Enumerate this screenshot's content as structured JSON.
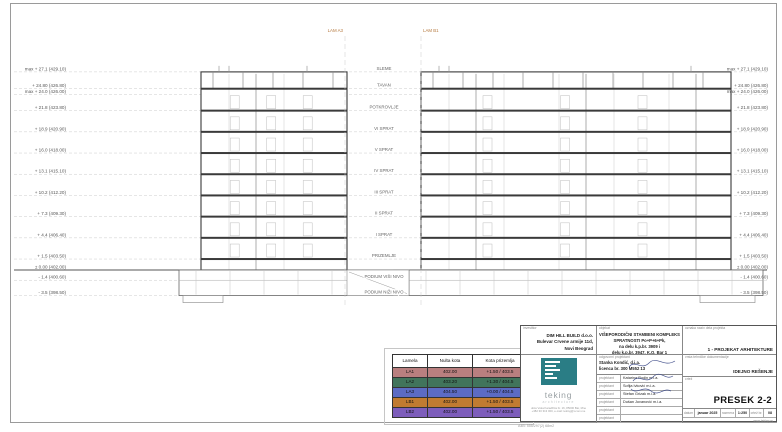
{
  "drawing": {
    "section_lines": [
      {
        "label": "LAM A3"
      },
      {
        "label": "LAM B1"
      }
    ],
    "levels": [
      {
        "elev": 27.1,
        "left": "max + 27.1 (429.10)",
        "right": "max + 27.1 (429.10)"
      },
      {
        "elev": 24.8,
        "left": "+ 24.80 (426.80)",
        "right": "+ 24.80 (426.80)"
      },
      {
        "elev": 24.0,
        "left": "max + 24.0 (426.00)",
        "right": "max + 24.0 (426.00)"
      },
      {
        "elev": 21.8,
        "left": "+ 21.8 (423.80)",
        "right": "+ 21.8 (423.80)"
      },
      {
        "elev": 18.9,
        "left": "+ 18.9 (420.90)",
        "right": "+ 18.9 (420.90)"
      },
      {
        "elev": 16.0,
        "left": "+ 16.0 (418.00)",
        "right": "+ 16.0 (418.00)"
      },
      {
        "elev": 13.1,
        "left": "+ 13.1 (415.10)",
        "right": "+ 13.1 (415.10)"
      },
      {
        "elev": 10.2,
        "left": "+ 10.2 (412.20)",
        "right": "+ 10.2 (412.20)"
      },
      {
        "elev": 7.3,
        "left": "+ 7.3 (409.30)",
        "right": "+ 7.3 (409.30)"
      },
      {
        "elev": 4.4,
        "left": "+ 4.4 (406.40)",
        "right": "+ 4.4 (406.40)"
      },
      {
        "elev": 1.5,
        "left": "+ 1.5 (403.50)",
        "right": "+ 1.5 (403.50)"
      },
      {
        "elev": 0.0,
        "left": "± 0.00 (402.00)",
        "right": "± 0.00 (402.00)"
      },
      {
        "elev": -1.4,
        "left": "- 1.4 (400.60)",
        "right": "- 1.4 (400.60)"
      },
      {
        "elev": -3.5,
        "left": "- 3.5 (398.50)",
        "right": "- 3.5 (398.50)"
      }
    ],
    "floors": [
      {
        "name": "SLEME",
        "elev": 27.1
      },
      {
        "name": "TAVAN",
        "elev": 24.8
      },
      {
        "name": "POTKROVLJE",
        "elev": 21.8
      },
      {
        "name": "VI SPRAT",
        "elev": 18.9
      },
      {
        "name": "V SPRAT",
        "elev": 16.0
      },
      {
        "name": "IV SPRAT",
        "elev": 13.1
      },
      {
        "name": "III SPRAT",
        "elev": 10.2
      },
      {
        "name": "II SPRAT",
        "elev": 7.3
      },
      {
        "name": "I SPRAT",
        "elev": 4.4
      },
      {
        "name": "PRIZEMLJE",
        "elev": 1.5
      },
      {
        "name": "PODIUM VIŠI NIVO",
        "elev": -1.4
      },
      {
        "name": "PODIUM NIŽI NIVO",
        "elev": -3.5
      }
    ],
    "marker_color": "#b5793f"
  },
  "legend": {
    "headers": [
      "Lamela",
      "Nulta kota",
      "Kota prizemlja"
    ],
    "rows": [
      {
        "lamela": "LA1",
        "nulta": "402.00",
        "prizemlje": "+1.50 / 403.5",
        "color": "#b97f7f"
      },
      {
        "lamela": "LA2",
        "nulta": "403.20",
        "prizemlje": "+1.30 / 404.5",
        "color": "#41745b"
      },
      {
        "lamela": "LA3",
        "nulta": "404.50",
        "prizemlje": "+0.00 / 404.5",
        "color": "#5c6bc4"
      },
      {
        "lamela": "LB1",
        "nulta": "402.00",
        "prizemlje": "+1.50 / 403.5",
        "color": "#c07b31"
      },
      {
        "lamela": "LB2",
        "nulta": "402.00",
        "prizemlje": "+1.50 / 403.5",
        "color": "#7d5dbb"
      }
    ]
  },
  "titleblock": {
    "investitor_label": "investitor",
    "investitor": [
      "DIM HILL BUILD d.o.o.",
      "Bulevar Crvene armije 11d,",
      "Novi Beograd"
    ],
    "objekat_label": "objekat",
    "objekat": [
      "VIŠEPORODIČNI STAMBENI KOMPLEKS",
      "SPRATNOSTI Po+P+6+Pk,",
      "na delu k.p.br. 3909 i",
      "delu k.p.br. 3947, K.O. Bar 1"
    ],
    "oznaka_label": "oznaka naziv dela projekta",
    "oznaka": "1 - PROJEKAT ARHITEKTURE",
    "odg_label": "odgovorni projektant",
    "odg_name": "Stanka Kondić, d.i.a.",
    "odg_licenca": "licenca br. 300 M552 13",
    "projektant_label": "projektant",
    "projektanti": [
      "Katarina Rodin m.i.a.",
      "Sofija Ivković m.i.a.",
      "Stefan Grizak m.i.a.",
      "Dušan Jovanović m.i.a.",
      "",
      ""
    ],
    "vrsta_label": "vrsta tehničke dokumentacije",
    "vrsta": "IDEJNO REŠENJE",
    "crtez_label": "crtež",
    "crtez": "PRESEK 2-2",
    "datum_label": "datum",
    "datum": "januar 2025",
    "razmera_label": "razmera",
    "razmera": "1:250",
    "crtez_br_label": "crtež br.",
    "crtez_br": "08",
    "website": "www.teking.rs",
    "logo": {
      "brand": "teking",
      "sub": "architecture",
      "address1": "ulica Vuka Karadžića br. 16, 85000 Bar, Mne",
      "address2": "+382 30 313 000, e-mail: teking@t-com.me",
      "color": "#2a7d85"
    }
  },
  "footer_note": "A4B: 555/297(2) 68m2"
}
